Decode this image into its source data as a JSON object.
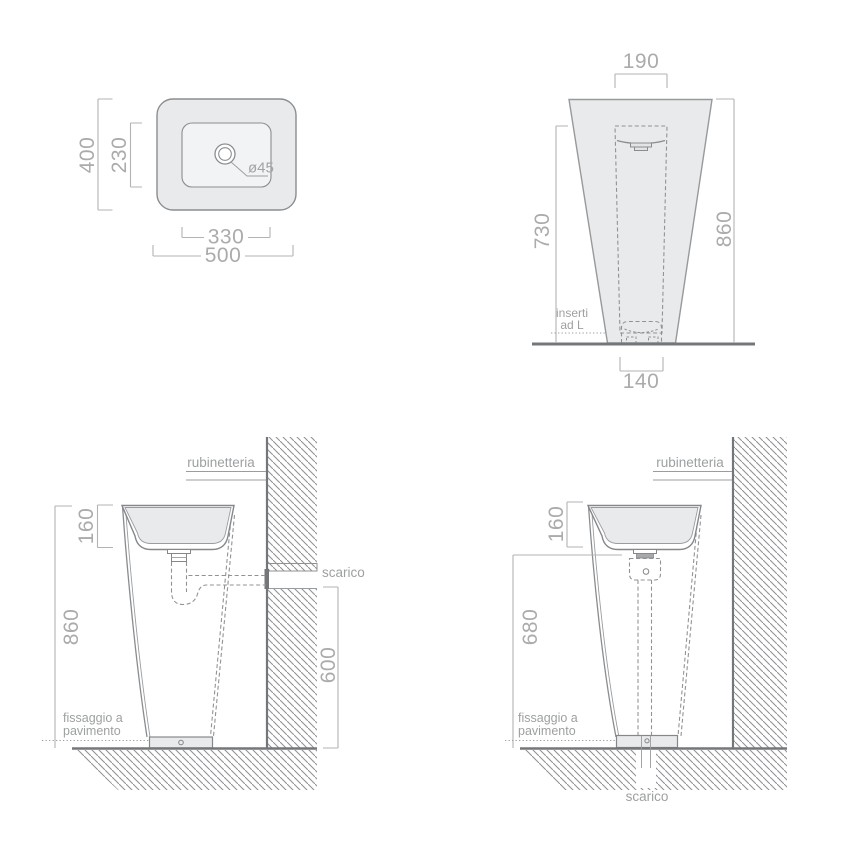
{
  "colors": {
    "object_line": "#8a8d90",
    "object_dark": "#74777a",
    "dimension_line": "#b1b3b5",
    "label_text": "#9da0a2",
    "number_text": "#a9abad",
    "body_fill": "#e9eaeb"
  },
  "plan_view": {
    "overall_width": "500",
    "inner_width": "330",
    "overall_depth": "400",
    "inner_depth": "230",
    "drain_diameter": "ø45"
  },
  "front_view": {
    "top_width": "190",
    "inner_height": "730",
    "overall_height": "860",
    "base_width": "140",
    "insert_note_line1": "inserti",
    "insert_note_line2": "ad L"
  },
  "side_view_wall_drain": {
    "faucet_label": "rubinetteria",
    "drain_label": "scarico",
    "rim_height": "160",
    "overall_height": "860",
    "drain_outlet_height": "600",
    "floor_fixing_line1": "fissaggio a",
    "floor_fixing_line2": "pavimento"
  },
  "side_view_floor_drain": {
    "faucet_label": "rubinetteria",
    "rim_height": "160",
    "drain_run_height": "680",
    "floor_fixing_line1": "fissaggio a",
    "floor_fixing_line2": "pavimento",
    "drain_label": "scarico"
  }
}
